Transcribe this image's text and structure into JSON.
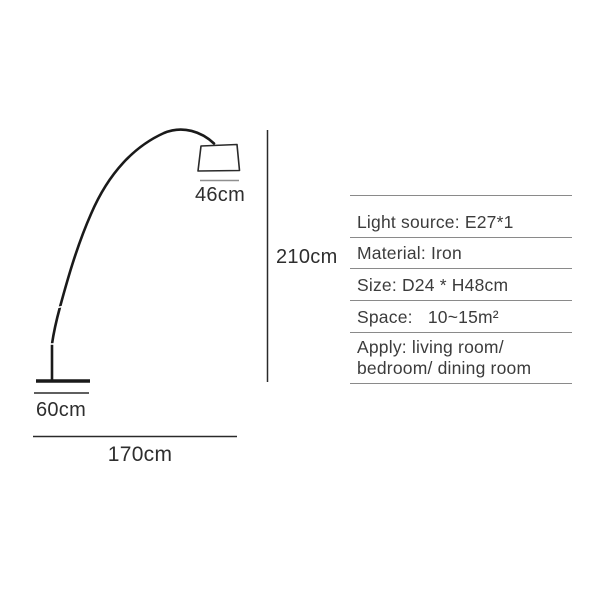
{
  "product_diagram": {
    "type": "arc-floor-lamp-dimension-diagram",
    "labels": {
      "shade_width": "46cm",
      "height": "210cm",
      "base_width": "60cm",
      "total_width": "170cm"
    }
  },
  "spec_table": {
    "rows": [
      "Light source: E27*1",
      "Material: Iron",
      "Size: D24 * H48cm",
      "Space:   10~15m²",
      "Apply: living room/\nbedroom/ dining room"
    ]
  },
  "colors": {
    "drawing_stroke": "#1a1a1a",
    "dimension_line": "#2a2a2a",
    "shade_underline": "#8f8f8f",
    "table_line": "#8a8a8a",
    "spec_text": "#3c3c3c",
    "label_text": "#2e2e2e",
    "background": "#ffffff"
  }
}
